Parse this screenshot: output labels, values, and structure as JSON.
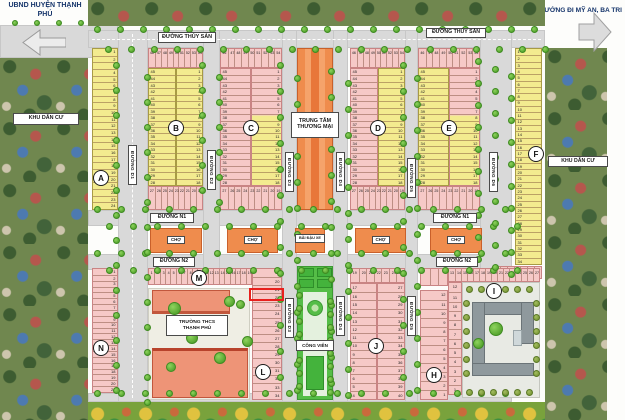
{
  "corners": {
    "top_left": "UBND HUYỆN THẠNH PHÚ",
    "top_right": "HƯỚNG ĐI MỸ AN, BA TRI"
  },
  "banners": {
    "left": "HUYỆN THẠNH PHÚ",
    "right": "THẠNH PHÚ"
  },
  "area_labels": {
    "residential": "KHU DÂN CƯ",
    "commercial_center": "TRUNG TÂM THƯƠNG MẠI",
    "market": "CHỢ",
    "parking": "BÃI ĐẬU XE",
    "park": "CÔNG VIÊN",
    "school_line1": "TRƯỜNG THCS",
    "school_line2": "THẠNH PHÚ"
  },
  "streets": {
    "horizontal": [
      "ĐƯỜNG THỦY SẢN",
      "ĐƯỜNG N1",
      "ĐƯỜNG N2"
    ],
    "vertical": [
      "ĐƯỜNG D1",
      "ĐƯỜNG D2",
      "ĐƯỜNG D3",
      "ĐƯỜNG D4",
      "ĐƯỜNG D5",
      "ĐƯỜNG D6"
    ]
  },
  "blocks": {
    "A": {
      "letter": "A",
      "numbers": {
        "start": 1,
        "end": 24
      }
    },
    "B": {
      "letter": "B",
      "top": {
        "start": 46,
        "end": 54
      },
      "left": {
        "start": 45,
        "end": 28
      },
      "right": {
        "start": 1,
        "end": 18
      },
      "bottom": {
        "start": 27,
        "end": 19
      }
    },
    "C": {
      "letter": "C",
      "top": {
        "start": 46,
        "end": 54
      },
      "left": {
        "start": 45,
        "end": 28
      },
      "right": {
        "start": 1,
        "end": 18
      },
      "bottom": {
        "start": 27,
        "end": 19
      }
    },
    "D": {
      "letter": "D",
      "top": {
        "start": 46,
        "end": 54
      },
      "left": {
        "start": 45,
        "end": 28
      },
      "right": {
        "start": 1,
        "end": 18
      },
      "bottom": {
        "start": 27,
        "end": 19
      }
    },
    "E": {
      "letter": "E",
      "top": {
        "start": 46,
        "end": 54
      },
      "left": {
        "start": 45,
        "end": 28
      },
      "right": {
        "start": 1,
        "end": 18
      },
      "bottom": {
        "start": 27,
        "end": 19
      }
    },
    "F": {
      "letter": "F",
      "numbers": {
        "start": 1,
        "end": 34
      },
      "south_row": {
        "start": 21,
        "end": 27
      }
    },
    "N": {
      "letter": "N",
      "numbers": {
        "start": 1,
        "end": 21
      }
    },
    "M": {
      "letter": "M",
      "row": {
        "start": 1,
        "end": 19
      },
      "column": {
        "start": 19,
        "end": 34
      }
    },
    "L": {
      "letter": "L"
    },
    "J": {
      "letter": "J",
      "top": {
        "start": 19,
        "end": 25
      },
      "left": {
        "start": 17,
        "end": 4
      },
      "right": {
        "start": 27,
        "end": 40
      }
    },
    "H": {
      "letter": "H",
      "numbers": {
        "start": 12,
        "end": 1
      }
    },
    "I": {
      "letter": "I",
      "top": {
        "start": 13,
        "end": 27
      },
      "left": {
        "start": 12,
        "end": 1
      }
    }
  },
  "highlight": {
    "block": "M",
    "lot": "22",
    "color": "#e8201d"
  },
  "colors": {
    "lot_pink": "#f6c9c7",
    "lot_yellow": "#f3eb8f",
    "orange_building": "#ef8c4d",
    "park_green": "#55bd47",
    "road_gray": "#d9d9d9",
    "school_salmon": "#ee9477",
    "gray_building": "#8f999d",
    "navy_text": "#16356b",
    "banner_green": "#2f9e3f"
  }
}
